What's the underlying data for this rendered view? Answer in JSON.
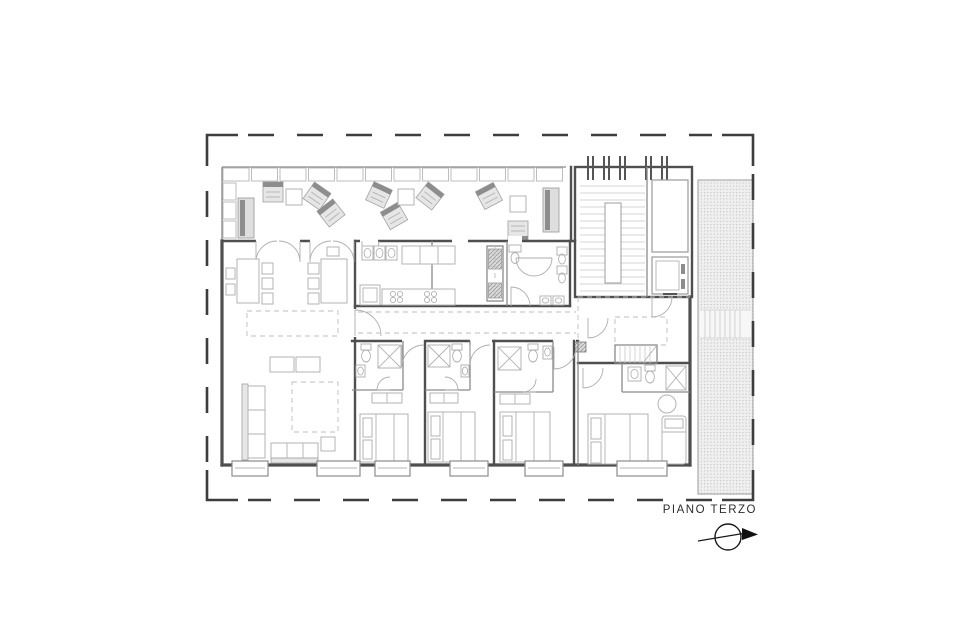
{
  "plan": {
    "title": "PIANO TERZO"
  },
  "icons": {
    "north_arrow": "north-arrow"
  },
  "colors": {
    "background": "#ffffff",
    "boundary_line": "#3d3d3d",
    "wall_line": "#4f4f4f",
    "partition_line": "#8a8a8a",
    "furniture_line": "#b3b3b3",
    "furniture_fill": "#e6e6e6",
    "accent_fill": "#8d8d8d",
    "hatch_fill": "#efefef",
    "hatch_dot": "#c3c3c3",
    "label_text": "#2e2e2e"
  }
}
